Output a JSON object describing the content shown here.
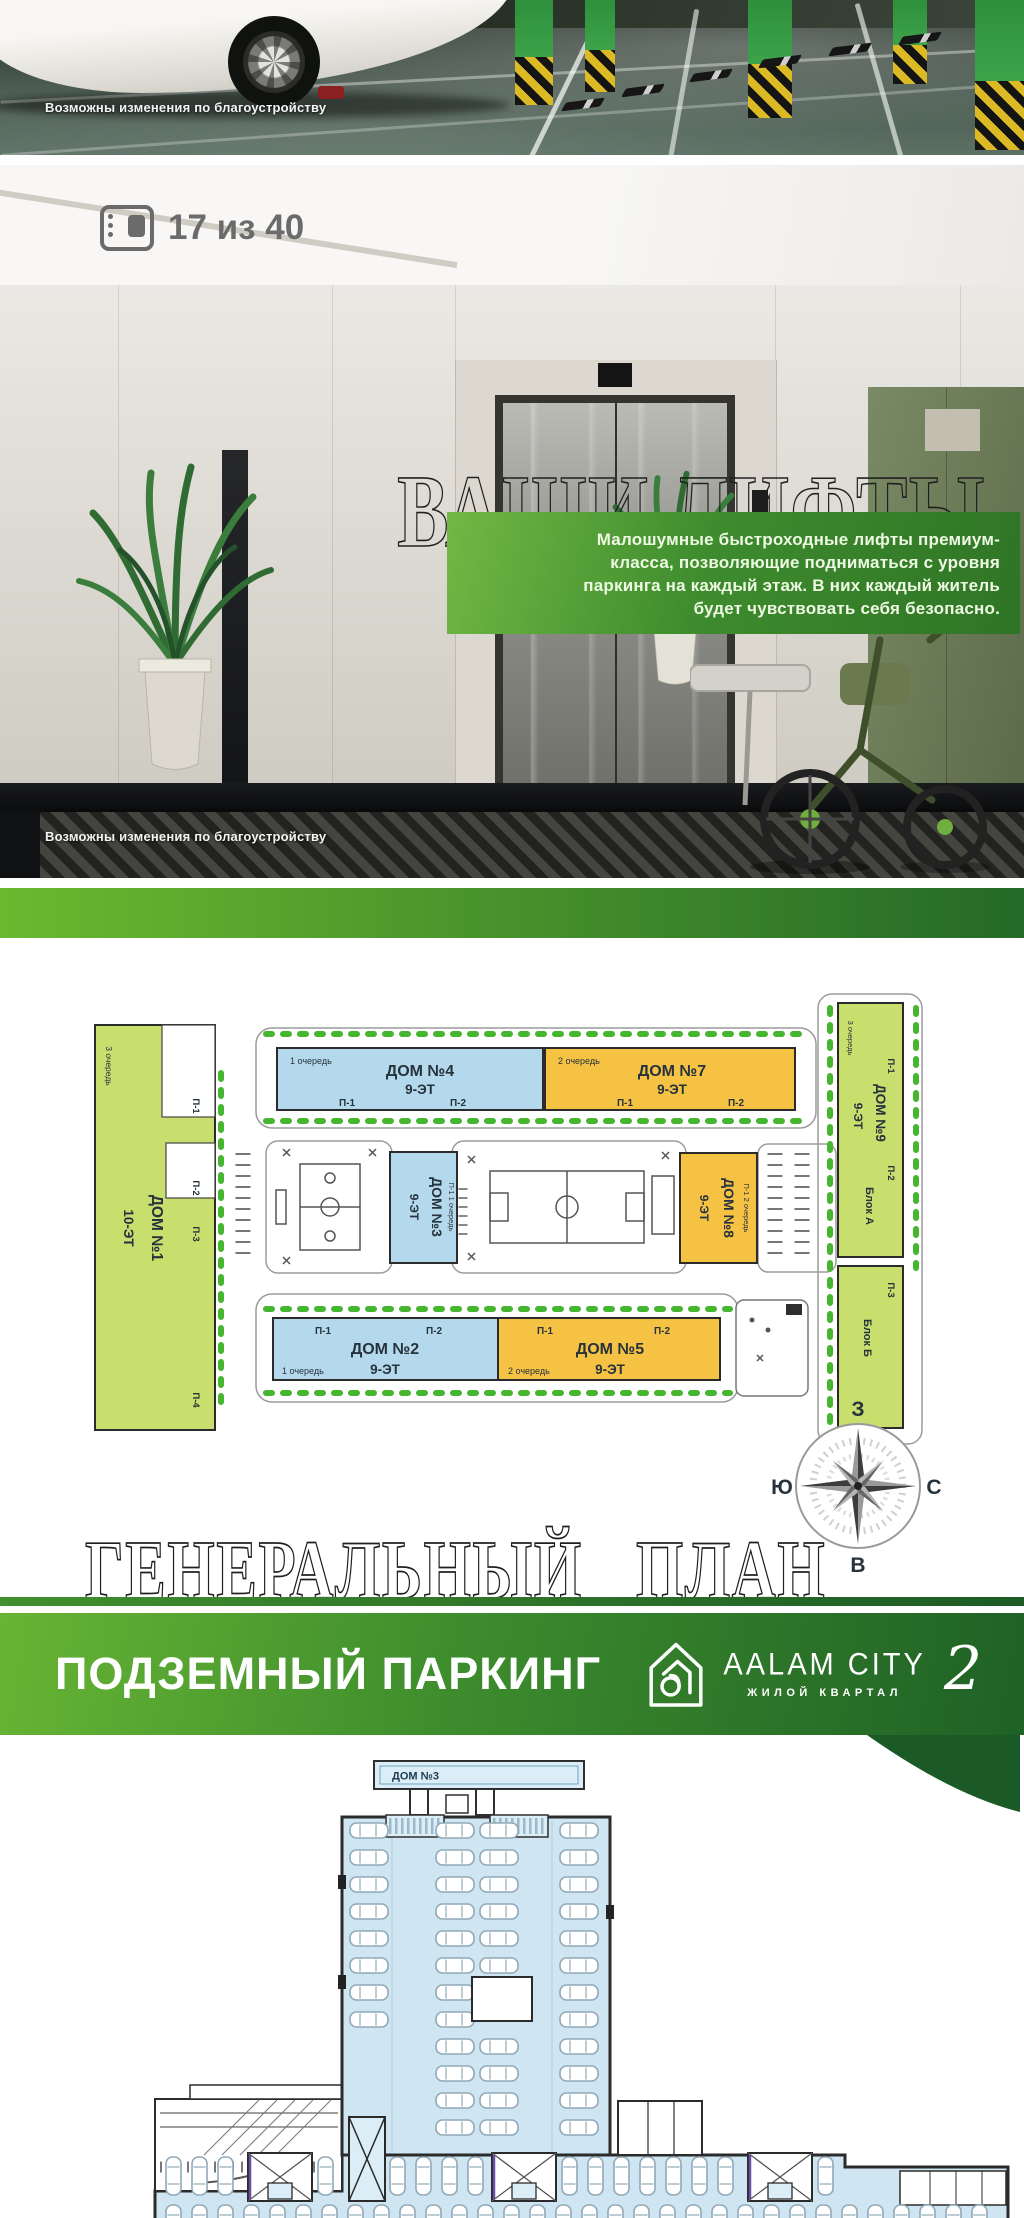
{
  "meta": {
    "slide_counter": "17 из 40"
  },
  "photo_top": {
    "caption": "Возможны изменения по благоустройству"
  },
  "lifts": {
    "title": "ВАШИ ЛИФТЫ",
    "description_lines": [
      "Малошумные быстроходные лифты премиум-",
      "класса, позволяющие подниматься с уровня",
      "паркинга на каждый этаж. В них каждый житель",
      "будет чувствовать себя безопасно."
    ],
    "caption": "Возможны изменения по благоустройству"
  },
  "master_plan": {
    "title": "ГЕНЕРАЛЬНЫЙ ПЛАН",
    "compass": {
      "top": "З",
      "right": "С",
      "bottom": "В",
      "left": "Ю"
    },
    "buildings": {
      "dom1": {
        "name": "ДОМ №1",
        "floors": "10-ЭТ",
        "queue": "3 очередь",
        "p1": "П-1",
        "p2": "П-2",
        "p3": "П-3",
        "p4": "П-4"
      },
      "dom2": {
        "name": "ДОМ №2",
        "floors": "9-ЭТ",
        "queue": "1 очередь",
        "p1": "П-1",
        "p2": "П-2"
      },
      "dom3": {
        "name": "ДОМ №3",
        "floors": "9-ЭТ",
        "side": "П-1 1 очередь"
      },
      "dom4": {
        "name": "ДОМ №4",
        "floors": "9-ЭТ",
        "queue": "1 очередь",
        "p1": "П-1",
        "p2": "П-2"
      },
      "dom5": {
        "name": "ДОМ №5",
        "floors": "9-ЭТ",
        "queue": "2 очередь",
        "p1": "П-1",
        "p2": "П-2"
      },
      "dom7": {
        "name": "ДОМ №7",
        "floors": "9-ЭТ",
        "queue": "2 очередь",
        "p1": "П-1",
        "p2": "П-2"
      },
      "dom8": {
        "name": "ДОМ №8",
        "floors": "9-ЭТ",
        "side": "П-1 2 очередь"
      },
      "dom9": {
        "name": "ДОМ №9",
        "floors": "9-ЭТ",
        "queue": "3 очередь",
        "p1": "П-1",
        "p2": "П-2",
        "block_a": "Блок А",
        "p3": "П-3",
        "block_b": "Блок Б"
      }
    }
  },
  "parking": {
    "title": "ПОДЗЕМНЫЙ ПАРКИНГ",
    "logo": {
      "brand": "AALAM CITY",
      "number": "2",
      "tagline": "ЖИЛОЙ КВАРТАЛ"
    },
    "plan": {
      "dom_label": "ДОМ №3"
    }
  },
  "colors": {
    "accent_green_light": "#63b231",
    "accent_green_dark": "#1e5f27",
    "building_blue": "#b5d9ec",
    "building_yellow": "#f6c244",
    "building_green": "#c9df6d",
    "plan_fill_blue": "#cfe6f2"
  }
}
